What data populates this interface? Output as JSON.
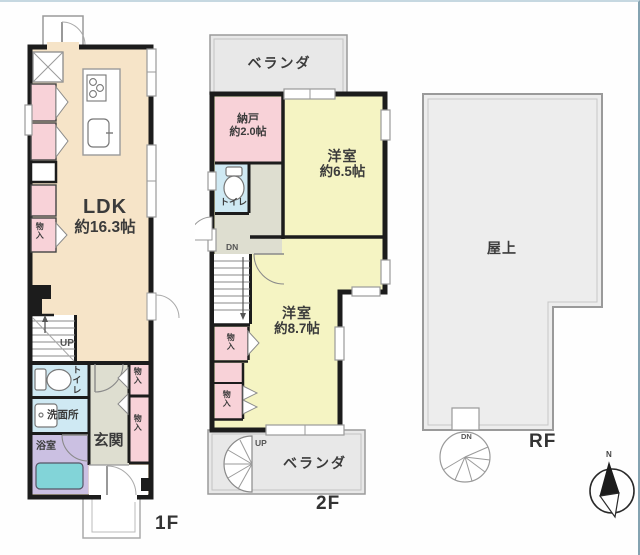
{
  "palette": {
    "wall": "#1c1c1c",
    "ldk_fill": "#f6e4c8",
    "room_yellow": "#f5f4c3",
    "storage_pink": "#f8d2d8",
    "wet_blue": "#cfe9f3",
    "bath_lavender": "#cbc0e2",
    "tub_teal": "#82d4d8",
    "hall_green": "#deded0",
    "veranda_gray": "#e8e8e8",
    "roof_gray": "#ededed"
  },
  "floor1": {
    "floor_label": "1F",
    "ldk_name": "LDK",
    "ldk_area": "約16.3帖",
    "stairs_up": "UP",
    "toilet": "トイレ",
    "washroom": "洗面所",
    "bathroom": "浴室",
    "entrance": "玄関",
    "storage": "物入"
  },
  "floor2": {
    "floor_label": "2F",
    "veranda_top": "ベランダ",
    "storage_room_name": "納戸",
    "storage_room_area": "約2.0帖",
    "room1_name": "洋室",
    "room1_area": "約6.5帖",
    "toilet": "トイレ",
    "stairs_down": "DN",
    "storage": "物入",
    "room2_name": "洋室",
    "room2_area": "約8.7帖",
    "spiral_up": "UP",
    "veranda_bottom": "ベランダ"
  },
  "roof": {
    "floor_label": "RF",
    "rooftop": "屋上",
    "spiral_down": "DN",
    "compass_north": "N"
  }
}
